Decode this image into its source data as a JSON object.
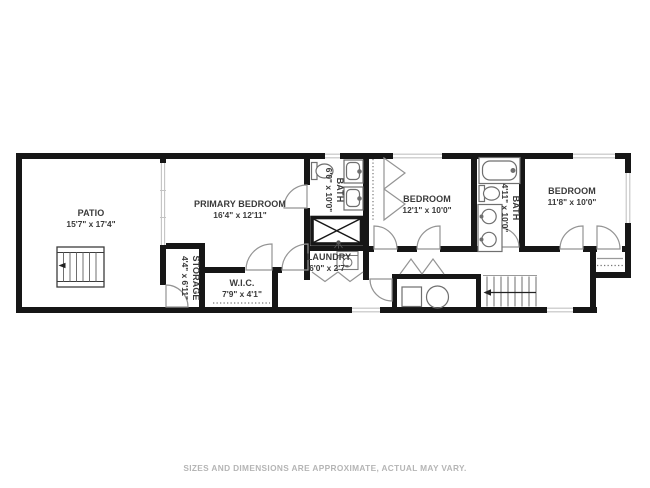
{
  "floor_plan": {
    "rooms": [
      {
        "id": "patio",
        "label": "PATIO",
        "dims": "15'7\" x 17'4\"",
        "orientation": "horizontal"
      },
      {
        "id": "primary-bedroom",
        "label": "PRIMARY BEDROOM",
        "dims": "16'4\" x 12'11\"",
        "orientation": "horizontal"
      },
      {
        "id": "primary-bath",
        "label": "BATH",
        "dims": "6'0\" x 10'0\"",
        "orientation": "vertical"
      },
      {
        "id": "storage",
        "label": "STORAGE",
        "dims": "4'4\" x 6'11\"",
        "orientation": "vertical"
      },
      {
        "id": "walk-in-closet",
        "label": "W.I.C.",
        "dims": "7'9\" x 4'1\"",
        "orientation": "horizontal"
      },
      {
        "id": "laundry",
        "label": "LAUNDRY",
        "dims": "6'0\" x 2'7\"",
        "orientation": "horizontal"
      },
      {
        "id": "bedroom-2",
        "label": "BEDROOM",
        "dims": "12'1\" x 10'0\"",
        "orientation": "horizontal"
      },
      {
        "id": "bath-2",
        "label": "BATH",
        "dims": "4'11\" x 10'0\"",
        "orientation": "vertical"
      },
      {
        "id": "bedroom-3",
        "label": "BEDROOM",
        "dims": "11'8\" x 10'0\"",
        "orientation": "horizontal"
      }
    ],
    "icons": [
      "toilet-icon",
      "sink-icon",
      "bathtub-icon",
      "washer-icon",
      "shower-icon",
      "stairs-icon",
      "door-arc-icon",
      "window-icon",
      "closet-rod-icon"
    ],
    "colors": {
      "wall": "#161616",
      "window": "#c3c3c3",
      "door": "#949494",
      "fixture": "#6f6f6f",
      "label": "#3a3a3a",
      "disclaimer": "#b5b5b5"
    }
  },
  "disclaimer": "SIZES AND DIMENSIONS ARE APPROXIMATE, ACTUAL MAY VARY."
}
